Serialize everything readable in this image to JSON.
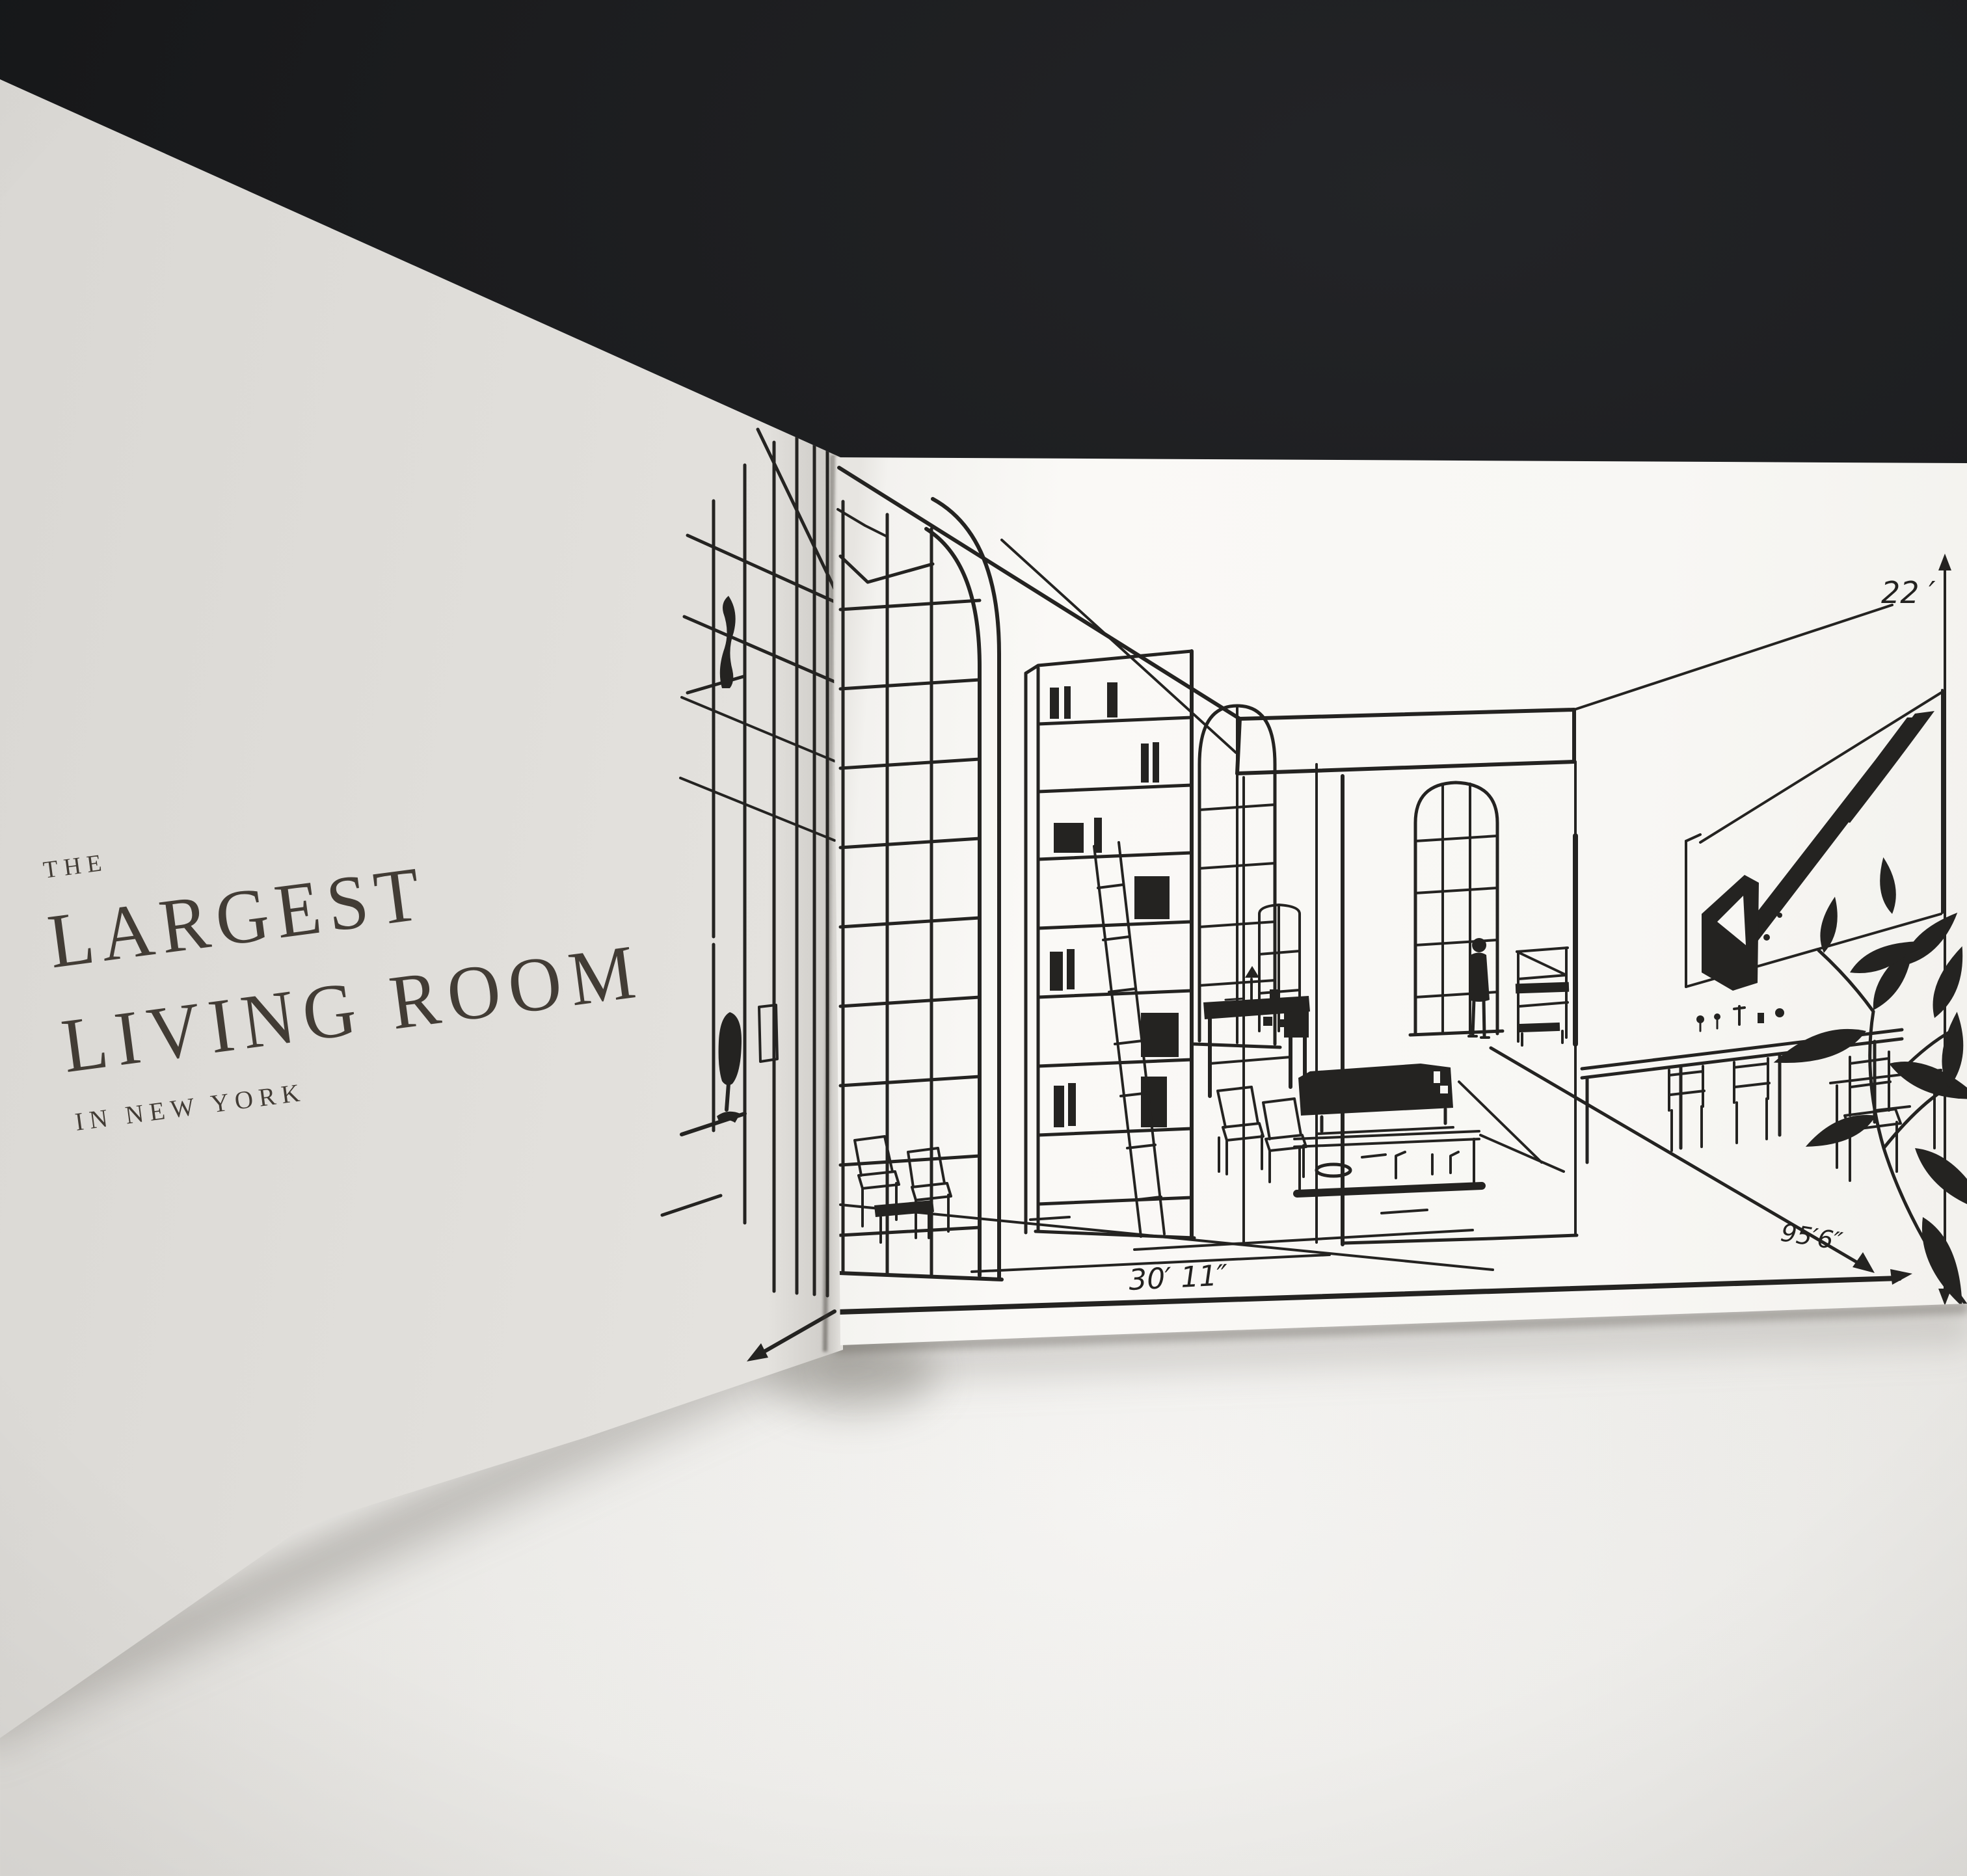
{
  "scene": {
    "colors": {
      "backdrop": "#1b1c1e",
      "table": "#ecebe8",
      "left_paper": "#e3e1dd",
      "right_paper": "#f8f7f4",
      "sketch_ink": "#242321",
      "title_ink": "#423c35"
    }
  },
  "left_page": {
    "eyebrow": "THE",
    "title_line_1": "LARGEST",
    "title_line_2": "LIVING ROOM",
    "subtitle": "IN NEW YORK"
  },
  "right_page": {
    "annotations": {
      "height": "22 ′",
      "diagonal": "95′6″",
      "width": "30′ 11″"
    }
  }
}
